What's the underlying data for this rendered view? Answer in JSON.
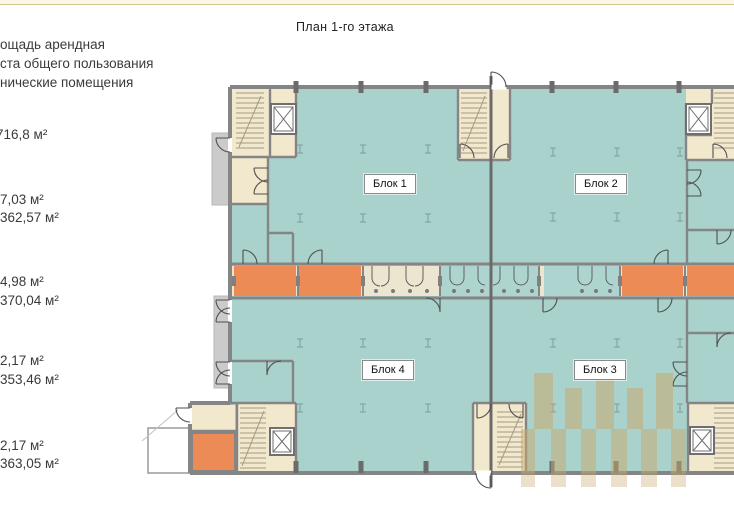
{
  "header": {
    "title": "План 1-го этажа"
  },
  "legend": {
    "labels": [
      {
        "text": "ощадь арендная"
      },
      {
        "text": "ста общего пользования"
      },
      {
        "text": "нические помещения"
      }
    ],
    "areas": [
      {
        "text": "716,8 м²"
      },
      {
        "text": "7,03 м²"
      },
      {
        "text": "362,57 м²"
      },
      {
        "text": "4,98 м²"
      },
      {
        "text": "370,04 м²"
      },
      {
        "text": "2,17 м²"
      },
      {
        "text": "353,46 м²"
      },
      {
        "text": "2,17 м²"
      },
      {
        "text": "363,05 м²"
      }
    ]
  },
  "plan": {
    "blocks": [
      {
        "label": "Блок 1"
      },
      {
        "label": "Блок 2"
      },
      {
        "label": "Блок 3"
      },
      {
        "label": "Блок 4"
      }
    ]
  },
  "colors": {
    "hall_teal": "#a9d2cc",
    "technical_orange": "#ec8b55",
    "core_cream": "#f1e8cd",
    "wall_gray": "#858585",
    "porch_gray": "#cbcbcb",
    "watermark_tan": "#c9a96e",
    "top_strip": "#faf6e2"
  }
}
